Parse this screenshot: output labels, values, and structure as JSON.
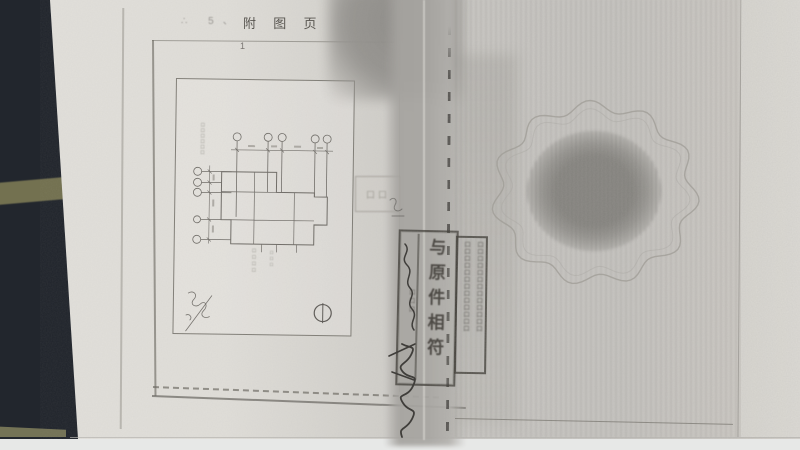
{
  "photo": {
    "description_colors": {
      "table_surface": "#22262d",
      "tan_stripe": "#7d7a55",
      "paper_left": "#dfddd8",
      "paper_right": "#c5c3bf",
      "photocopy_band": "#a8a6a2",
      "stamp_ink": "#3a3732"
    }
  },
  "page": {
    "title": "附 图 页",
    "page_number": "1",
    "faint_marks": "∴ 5、"
  },
  "drawing": {
    "micro_label_illegible": "口口口口口口",
    "caption_col1_illegible": "口口口口",
    "caption_col2_illegible": "口口口"
  },
  "stamps": {
    "match_stamp_text": "与原件相符",
    "match_stamp_side_illegible": "口口口",
    "dense_stamp_col1_illegible": "口口口口口口口口口口口口口",
    "dense_stamp_col2_illegible": "口口口口口口口口口口口口口",
    "faint_stamp_illegible": "口口"
  }
}
